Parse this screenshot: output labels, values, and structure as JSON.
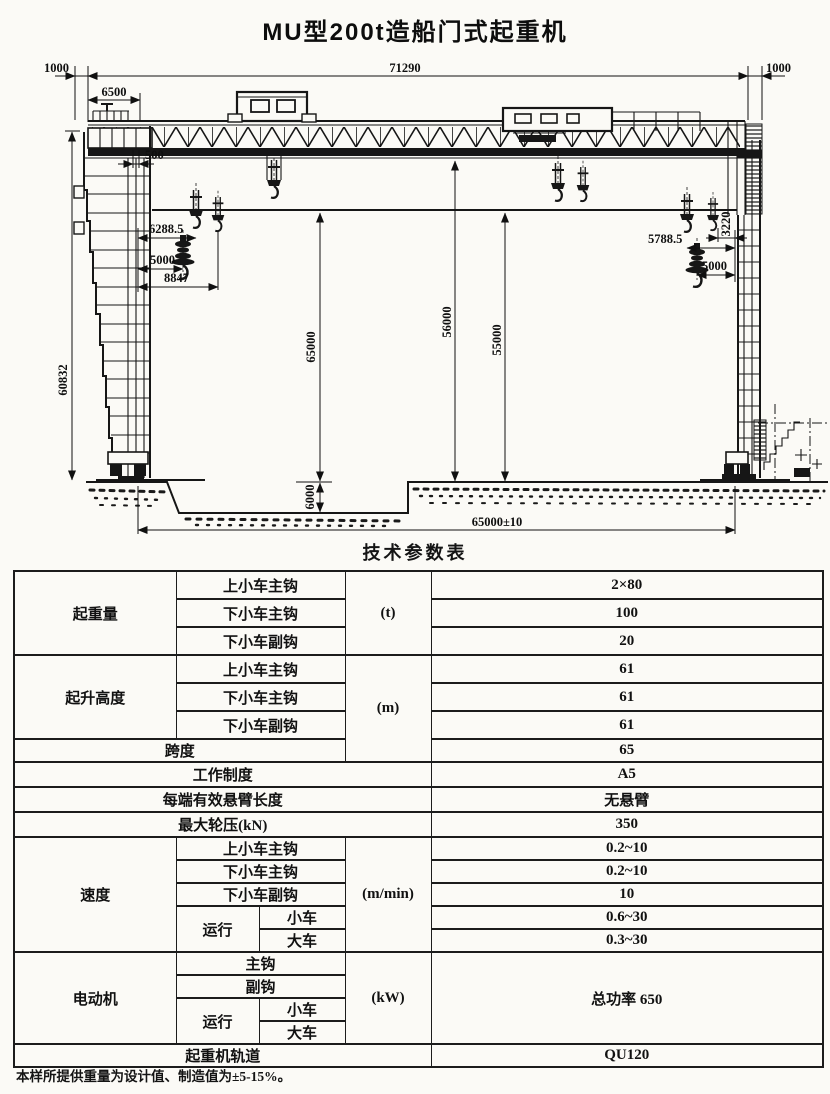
{
  "title": "MU型200t造船门式起重机",
  "table_title": "技术参数表",
  "footnote": "本样所提供重量为设计值、制造值为±5-15%。",
  "drawing": {
    "dims": {
      "top_left_gauge": "1000",
      "total_span": "71290",
      "top_right_gauge": "1000",
      "left_overhang": "6500",
      "leg_offset": "500",
      "left_hook_1": "6288.5",
      "left_hook_2": "5000",
      "left_hook_3": "8847",
      "right_hook_1": "5788.5",
      "right_hook_2": "3220",
      "right_hook_3": "5000",
      "left_leg_height": "60832",
      "height_main": "65000",
      "height_girder": "56000",
      "height_lower": "55000",
      "pit_depth": "6000",
      "rail_span": "65000±10"
    }
  },
  "table": {
    "lifting_capacity": {
      "label": "起重量",
      "unit": "(t)",
      "items": [
        {
          "name": "上小车主钩",
          "value": "2×80"
        },
        {
          "name": "下小车主钩",
          "value": "100"
        },
        {
          "name": "下小车副钩",
          "value": "20"
        }
      ]
    },
    "lifting_height": {
      "label": "起升高度",
      "unit": "(m)",
      "items": [
        {
          "name": "上小车主钩",
          "value": "61"
        },
        {
          "name": "下小车主钩",
          "value": "61"
        },
        {
          "name": "下小车副钩",
          "value": "61"
        }
      ]
    },
    "span": {
      "label": "跨度",
      "value": "65"
    },
    "work_duty": {
      "label": "工作制度",
      "value": "A5"
    },
    "cantilever": {
      "label": "每端有效悬臂长度",
      "value": "无悬臂"
    },
    "max_wheel_load": {
      "label": "最大轮压(kN)",
      "value": "350"
    },
    "speed": {
      "label": "速度",
      "unit": "(m/min)",
      "items": [
        {
          "name": "上小车主钩",
          "value": "0.2~10"
        },
        {
          "name": "下小车主钩",
          "value": "0.2~10"
        },
        {
          "name": "下小车副钩",
          "value": "10"
        }
      ],
      "travel": {
        "label": "运行",
        "items": [
          {
            "name": "小车",
            "value": "0.6~30"
          },
          {
            "name": "大车",
            "value": "0.3~30"
          }
        ]
      }
    },
    "motor": {
      "label": "电动机",
      "unit": "(kW)",
      "value": "总功率 650",
      "items": [
        {
          "name": "主钩"
        },
        {
          "name": "副钩"
        }
      ],
      "travel": {
        "label": "运行",
        "items": [
          {
            "name": "小车"
          },
          {
            "name": "大车"
          }
        ]
      }
    },
    "rail": {
      "label": "起重机轨道",
      "value": "QU120"
    }
  }
}
